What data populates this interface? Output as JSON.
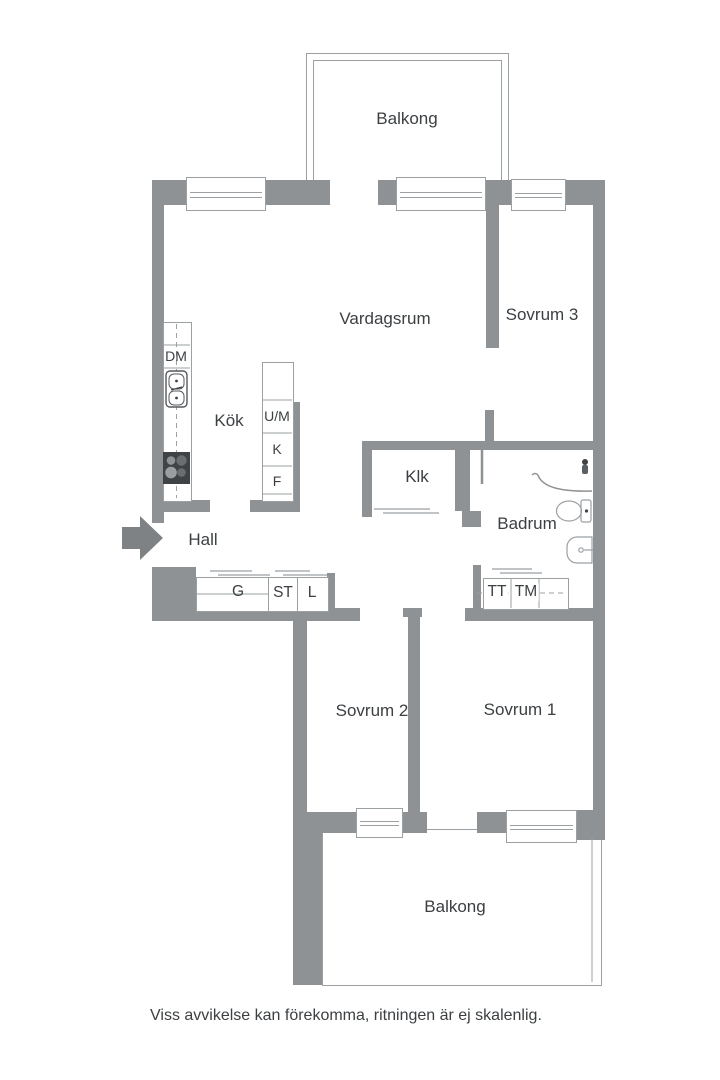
{
  "colors": {
    "wall": "#8e9295",
    "line": "#9ba0a3",
    "text": "#3c4043",
    "dark": "#3f4346"
  },
  "labels": {
    "balcony_top": "Balkong",
    "living_room": "Vardagsrum",
    "bedroom_3": "Sovrum 3",
    "kitchen": "Kök",
    "dishwasher": "DM",
    "oven_micro": "U/M",
    "fridge": "K",
    "freezer": "F",
    "closet": "Klk",
    "bathroom": "Badrum",
    "hall": "Hall",
    "wardrobe_g": "G",
    "cleaning_st": "ST",
    "linen_l": "L",
    "dryer_tt": "TT",
    "washer_tm": "TM",
    "bedroom_2": "Sovrum 2",
    "bedroom_1": "Sovrum 1",
    "balcony_bottom": "Balkong",
    "disclaimer": "Viss avvikelse kan förekomma, ritningen är ej skalenlig."
  }
}
